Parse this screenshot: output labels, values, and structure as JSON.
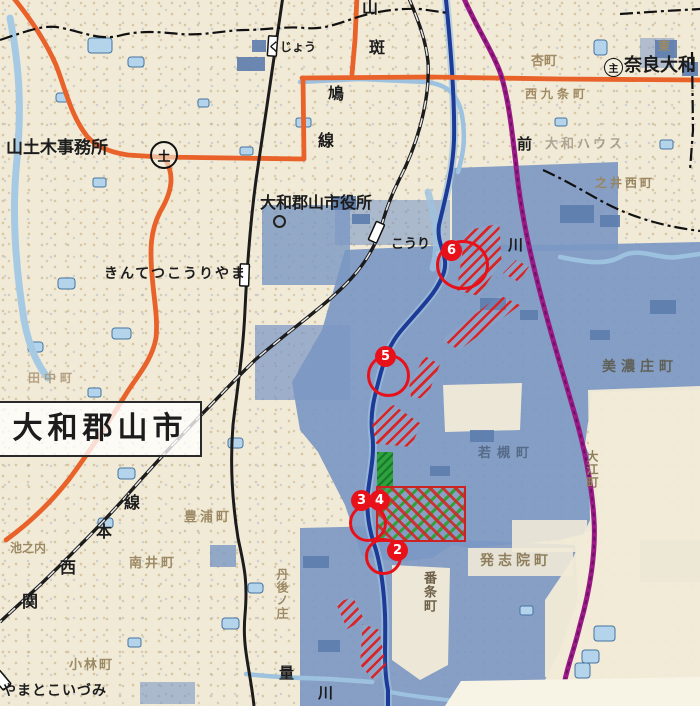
{
  "map": {
    "region_big_label": "大和郡山市",
    "labels": {
      "civil_office": "山土木事務所",
      "civil_office_badge": "土",
      "kujo_station": "くじょう",
      "road_char_yama": "山",
      "road_char_han": "斑",
      "road_char_hato": "鳩",
      "road_char_sen": "線",
      "route_badge": "主",
      "route_name": "奈良大和",
      "higashi": "東",
      "anzu_cho": "杏町",
      "nishi_kujo_cho": "西九条町",
      "city_hall": "大和郡山市役所",
      "kintetsu_koriyama_station": "きんてつこうりやま",
      "kouri": "こうり",
      "river_kawa_upper": "川",
      "mae": "前",
      "daiwa_house": "大和ハウス",
      "noii_nishi_cho": "之井西町",
      "kansai_k1": "線",
      "kansai_k2": "本",
      "kansai_k3": "西",
      "kansai_k4": "関",
      "tanaka_cho": "田中町",
      "toyoura_cho": "豊浦町",
      "ikenouchi": "池之内",
      "minamii_cho": "南井町",
      "kobayashi_cho": "小林町",
      "yamatokoizumi_station": "やまとこいづみ",
      "ryo": "量",
      "river_kawa_lower": "川",
      "tangonosho": "丹後ノ庄",
      "banjo_cho": "番条町",
      "hasshiin_cho": "発志院町",
      "minosho_cho": "美濃庄町",
      "oe_cho": "大江町",
      "wakatsuki_cho": "若槻町"
    },
    "markers": {
      "m2": "2",
      "m3": "3",
      "m4": "4",
      "m5": "5",
      "m6": "6"
    },
    "colors": {
      "flood_zone": "#7b97c3",
      "road_orange": "#e8622a",
      "railway_black": "#1c1c1c",
      "line_purple": "#9c1a88",
      "river_navy": "#1c3a96",
      "marker_red": "#e8111a",
      "hatch_red": "#de1e1e",
      "park_green": "#2ea23c",
      "paper_beige": "#f1ead7"
    }
  }
}
